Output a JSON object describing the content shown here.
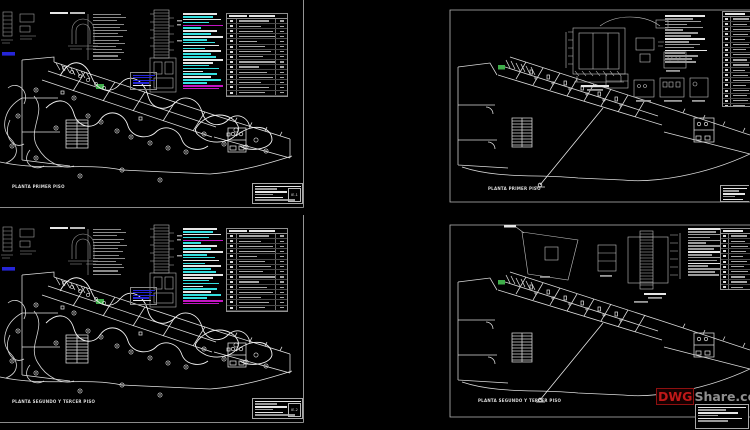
{
  "watermark": {
    "brand": "DWG",
    "suffix": "Share.co"
  },
  "sheets": [
    {
      "plan_label": "PLANTA PRIMER PISO",
      "sheet_no": "IE-1"
    },
    {
      "plan_label": "PLANTA PRIMER PISO",
      "sheet_no": ""
    },
    {
      "plan_label": "PLANTA SEGUNDO Y TERCER PISO",
      "sheet_no": "IE-2"
    },
    {
      "plan_label": "PLANTA SEGUNDO Y TERCER PISO",
      "sheet_no": ""
    }
  ],
  "colors": {
    "white": "#e6e6e6",
    "gray": "#9a9a9a",
    "gray2": "#8a8a8a",
    "cyan": "#35e0e0",
    "magenta": "#c315c3",
    "blue": "#2525d8",
    "green": "#3fae4a",
    "red": "#c01818",
    "background": "#000000"
  },
  "legends": {
    "elec_notes": [
      [
        34,
        "white"
      ],
      [
        30,
        "cyan"
      ],
      [
        38,
        "white"
      ],
      [
        26,
        "cyan"
      ],
      [
        40,
        "magenta"
      ],
      [
        18,
        "cyan"
      ],
      [
        34,
        "white"
      ],
      [
        28,
        "cyan"
      ],
      [
        40,
        "white"
      ],
      [
        24,
        "cyan"
      ],
      [
        32,
        "cyan"
      ],
      [
        36,
        "white"
      ],
      [
        22,
        "cyan"
      ],
      [
        38,
        "white"
      ],
      [
        28,
        "cyan"
      ],
      [
        33,
        "cyan"
      ],
      [
        40,
        "white"
      ],
      [
        30,
        "white"
      ],
      [
        26,
        "cyan"
      ],
      [
        36,
        "cyan"
      ],
      [
        20,
        "white"
      ],
      [
        34,
        "cyan"
      ],
      [
        28,
        "white"
      ],
      [
        38,
        "cyan"
      ],
      [
        24,
        "cyan"
      ],
      [
        40,
        "magenta"
      ],
      [
        36,
        "magenta"
      ]
    ],
    "san_notes": [
      [
        40,
        "white"
      ],
      [
        28,
        "gray"
      ],
      [
        36,
        "gray"
      ],
      [
        22,
        "gray"
      ],
      [
        38,
        "gray"
      ],
      [
        18,
        "gray"
      ],
      [
        33,
        "gray"
      ],
      [
        26,
        "gray"
      ],
      [
        40,
        "white"
      ],
      [
        24,
        "gray"
      ],
      [
        35,
        "gray"
      ],
      [
        29,
        "gray"
      ],
      [
        42,
        "white"
      ],
      [
        20,
        "gray"
      ],
      [
        33,
        "gray"
      ],
      [
        27,
        "gray"
      ],
      [
        31,
        "gray"
      ]
    ],
    "panel_lines": [
      [
        28,
        "gray2"
      ],
      [
        33,
        "gray2"
      ],
      [
        24,
        "gray2"
      ],
      [
        31,
        "gray2"
      ],
      [
        27,
        "gray2"
      ],
      [
        34,
        "gray2"
      ],
      [
        25,
        "gray2"
      ],
      [
        30,
        "gray2"
      ],
      [
        26,
        "gray2"
      ],
      [
        32,
        "gray2"
      ],
      [
        23,
        "gray2"
      ],
      [
        29,
        "gray2"
      ],
      [
        31,
        "gray2"
      ],
      [
        25,
        "gray2"
      ],
      [
        28,
        "gray2"
      ]
    ],
    "blue_rows": [
      [
        22,
        "blue"
      ],
      [
        19,
        "blue"
      ],
      [
        22,
        "blue"
      ],
      [
        16,
        "blue"
      ],
      [
        18,
        "white"
      ]
    ],
    "sym_rows": [
      30,
      22,
      34,
      36,
      18,
      26,
      32,
      24,
      38,
      20,
      28,
      34,
      22,
      30,
      26,
      36,
      18,
      28,
      32
    ],
    "san_rows": [
      16,
      14,
      17,
      15,
      12,
      16,
      13,
      17,
      14,
      16,
      12,
      15,
      17,
      13,
      16,
      14,
      15,
      12,
      16,
      13,
      15,
      14
    ],
    "tb_left": [
      [
        46,
        "white"
      ],
      [
        22,
        "gray"
      ],
      [
        32,
        "white"
      ],
      [
        18,
        "gray"
      ],
      [
        28,
        "white"
      ],
      [
        40,
        "gray"
      ]
    ],
    "tb_right": [
      [
        24,
        "white"
      ],
      [
        16,
        "gray"
      ],
      [
        22,
        "white"
      ],
      [
        12,
        "gray"
      ],
      [
        20,
        "white"
      ]
    ],
    "tb_br": [
      [
        48,
        "white"
      ],
      [
        28,
        "gray"
      ],
      [
        40,
        "white"
      ],
      [
        20,
        "gray"
      ],
      [
        44,
        "white"
      ],
      [
        30,
        "gray"
      ]
    ]
  }
}
